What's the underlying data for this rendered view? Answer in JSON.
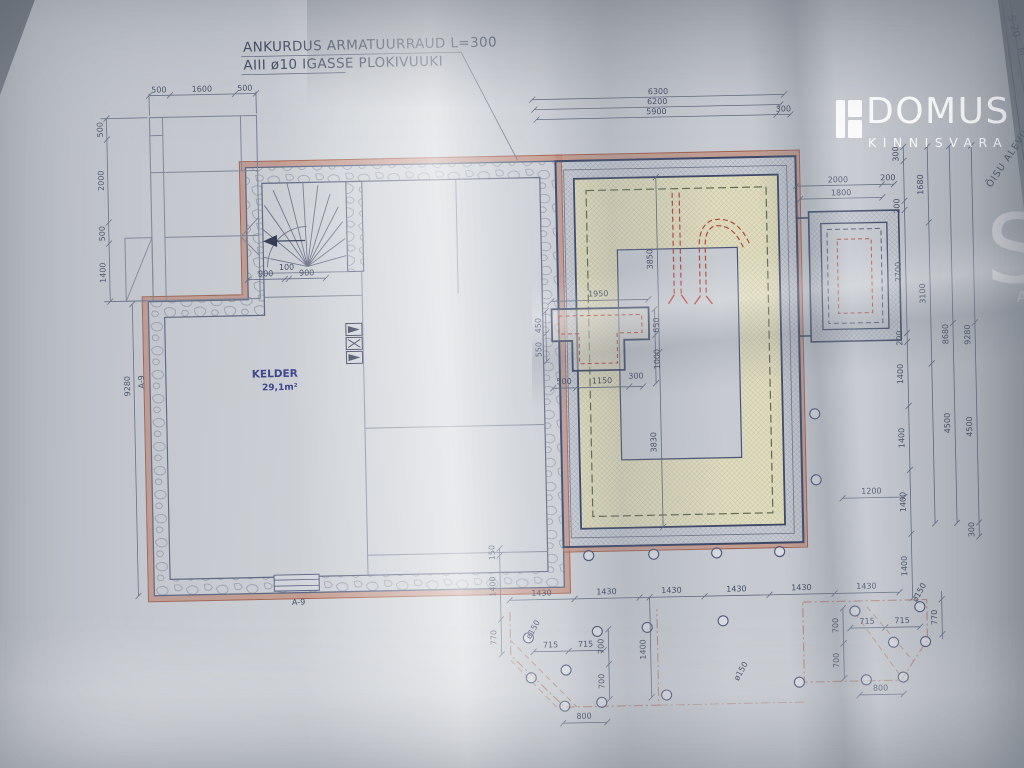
{
  "logo": {
    "word": "DOMUS",
    "sub": "KINNISVARA",
    "partial_s": "S",
    "partial_a": "A"
  },
  "edge": {
    "code": "S-20",
    "letter": "M",
    "location": "ÕISU ALEVIK"
  },
  "notes": {
    "l1": "ANKURDUS ARMATUURRAUD L=300",
    "l2": "AIII  ø10 IGASSE PLOKIVUUKI"
  },
  "room": {
    "name": "KELDER",
    "area": "29,1m²"
  },
  "labels": {
    "a9": "A-9",
    "a9b": "A-9"
  },
  "dims": {
    "tl": [
      "500",
      "1600",
      "500"
    ],
    "lv": [
      "500",
      "2000",
      "500",
      "1400"
    ],
    "ltot": "9280",
    "st": [
      "900",
      "100",
      "900"
    ],
    "tr": [
      "6300",
      "6200",
      "5900",
      "300"
    ],
    "ext": [
      "2000",
      "200",
      "1800"
    ],
    "rc1": [
      "300",
      "200",
      "2700",
      "200",
      "1400",
      "1400",
      "1400",
      "1400"
    ],
    "rc2": [
      "1680",
      "3100"
    ],
    "rc3": [
      "8680",
      "4500"
    ],
    "rc4": [
      "9280",
      "4500",
      "300"
    ],
    "ch": {
      "top": "1950",
      "b1": "500",
      "b2": "1150",
      "b3": "300",
      "l1": "450",
      "l2": "550",
      "r1": "650",
      "r2": "1000"
    },
    "iv": [
      "3850",
      "3830"
    ],
    "mid": "1200",
    "bb": [
      "150",
      "1400",
      "770"
    ],
    "tt": [
      "1430",
      "1430",
      "1430",
      "1430",
      "1430",
      "1430"
    ],
    "dl": {
      "h1": "715",
      "h2": "715",
      "v1": "700",
      "v2": "700",
      "v3": "1400",
      "b": "800",
      "p1": "ø150",
      "p2": "ø150"
    },
    "dr": {
      "h1": "715",
      "h2": "715",
      "v1": "700",
      "v2": "700",
      "v3": "770",
      "b": "800",
      "p": "ø150"
    }
  },
  "colors": {
    "paper": "#ccd0d6",
    "wall_navy": "#3c4767",
    "pink_band": "#c29080",
    "red_dashed": "#b5473c",
    "highlight_yellow": "#e9e2b2",
    "dim_text": "#3f4962"
  }
}
